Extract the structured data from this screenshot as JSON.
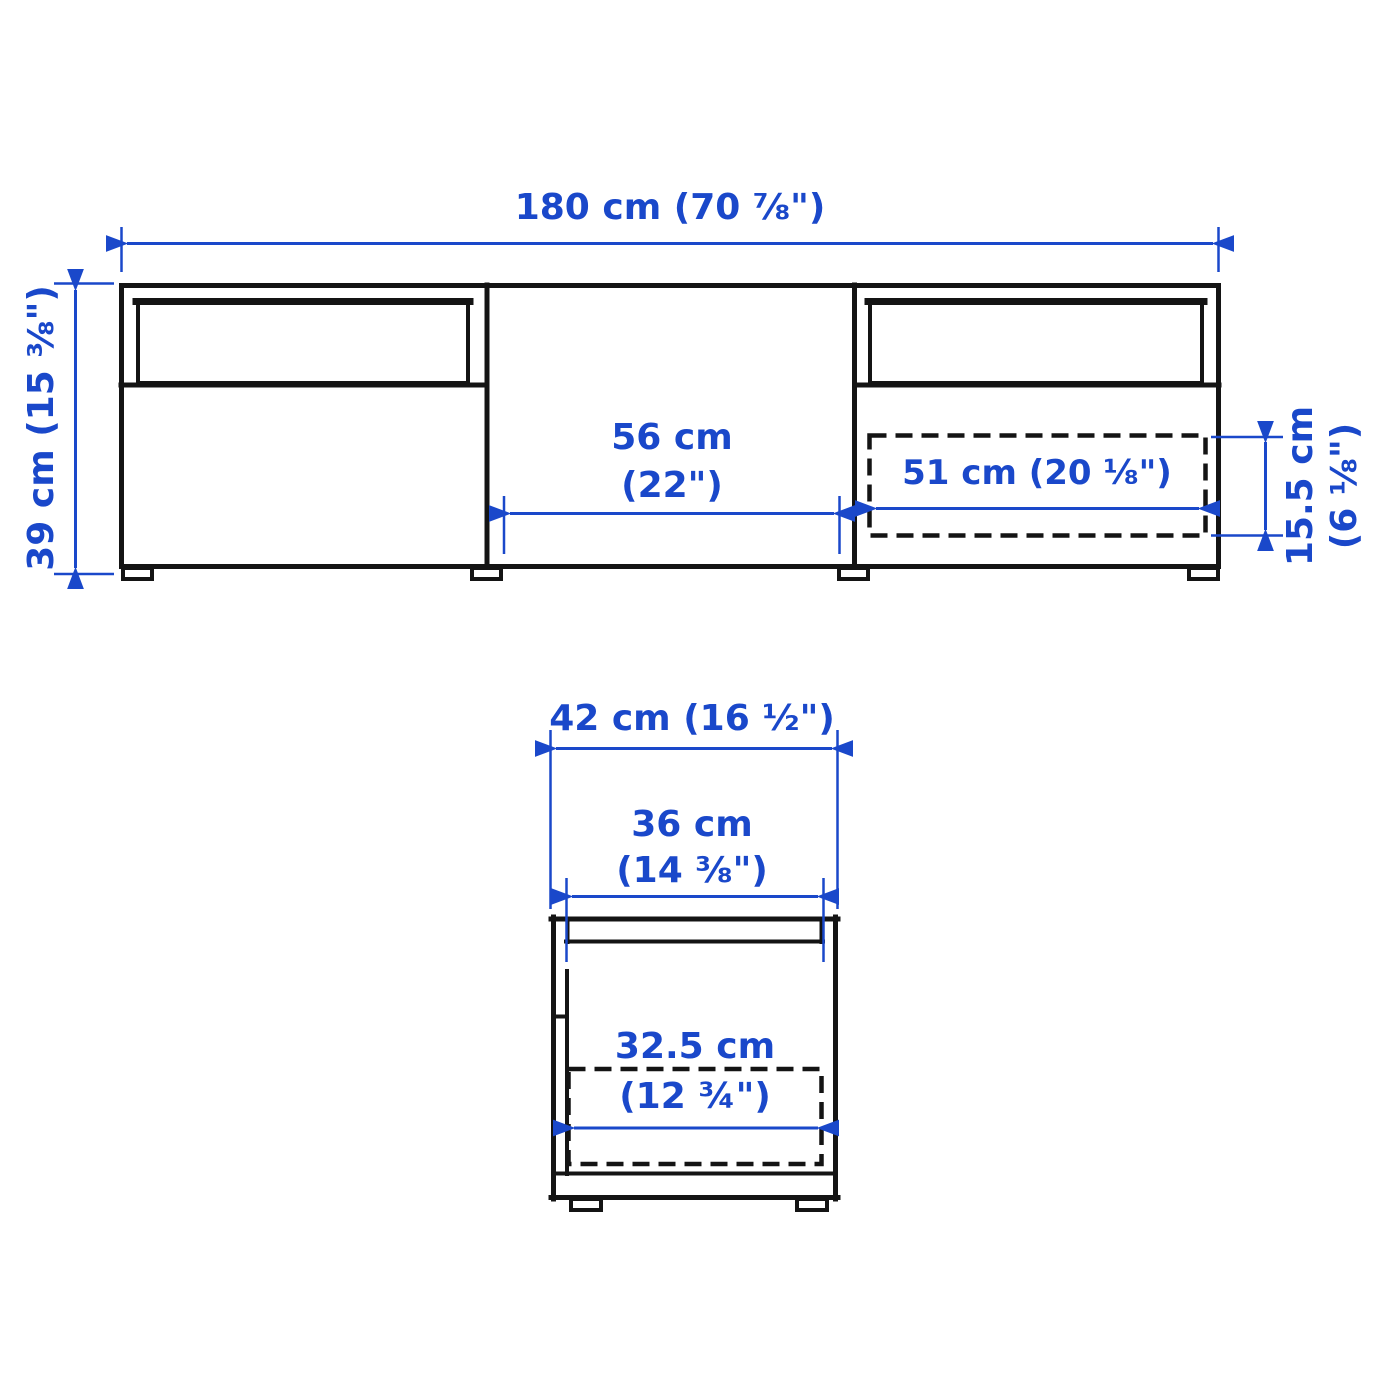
{
  "diagram": {
    "type": "furniture-dimension-drawing",
    "subject": "TV bench with drawers, front and side elevation views",
    "colors": {
      "dimension": "#1a48ca",
      "outline": "#141414",
      "background": "#ffffff"
    },
    "front_view": {
      "name": "front-view",
      "overall_width": "180 cm (70 ⅞\")",
      "overall_height": "39 cm (15 ⅜\")",
      "middle_section_width": [
        "56 cm",
        "(22\")"
      ],
      "drawer_inner_width": "51 cm (20 ⅛\")",
      "drawer_inner_height": [
        "15.5 cm",
        "(6 ⅛\")"
      ]
    },
    "side_view": {
      "name": "side-view",
      "overall_depth": "42 cm (16 ½\")",
      "inner_depth": [
        "36 cm",
        "(14 ⅜\")"
      ],
      "drawer_inner_depth": [
        "32.5 cm",
        "(12 ¾\")"
      ]
    }
  }
}
